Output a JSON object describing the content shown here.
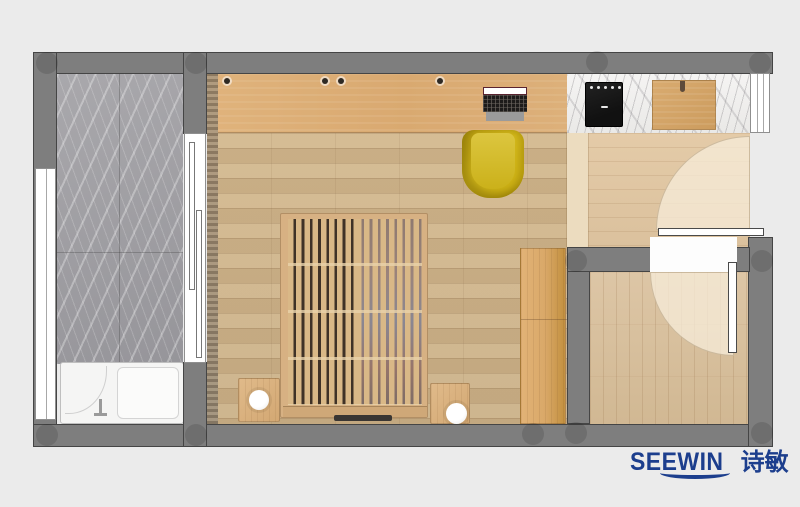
{
  "brand": {
    "wordmark": "SEEWIN",
    "cjk": "诗敏"
  },
  "colors": {
    "background": "#ebebeb",
    "wall": "#7e7e7e",
    "wall_outline": "#454545",
    "marble_floor": "#a4a3a7",
    "counter_marble": "#f2f1ef",
    "wood_floor": "#cdb48d",
    "desk_wood": "#dcad77",
    "entry_floor": "#e2c9a6",
    "balcony_floor": "#d8c0a0",
    "bed_wood": "#d9b887",
    "chair_yellow": "#ccb119",
    "cooktop_black": "#1b1b1b",
    "board_wood": "#d2a368",
    "fixture_white": "#f5f5f4",
    "logo_blue": "#1c3e8d"
  }
}
